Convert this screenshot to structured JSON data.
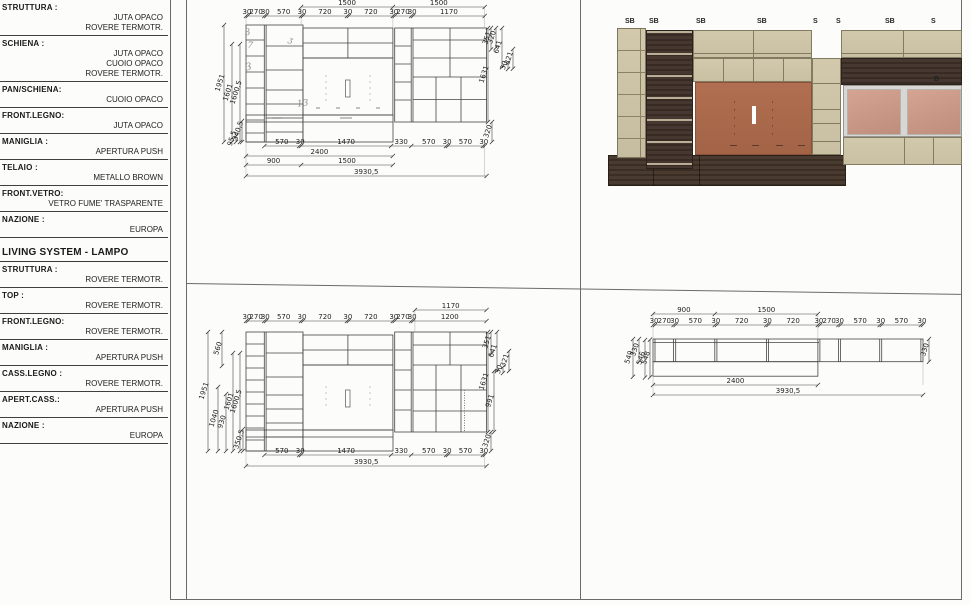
{
  "spec_block_top": {
    "rows": [
      {
        "label": "STRUTTURA  :",
        "values": [
          "JUTA OPACO",
          "ROVERE TERMOTR."
        ]
      },
      {
        "label": "SCHIENA    :",
        "values": [
          "JUTA OPACO",
          "CUOIO OPACO",
          "ROVERE TERMOTR."
        ]
      },
      {
        "label": "PAN/SCHIENA:",
        "values": [
          "CUOIO OPACO"
        ]
      },
      {
        "label": "FRONT.LEGNO:",
        "values": [
          "JUTA OPACO"
        ]
      },
      {
        "label": "MANIGLIA  :",
        "values": [
          "APERTURA PUSH"
        ]
      },
      {
        "label": "TELAIO    :",
        "values": [
          "METALLO BROWN"
        ]
      },
      {
        "label": "FRONT.VETRO:",
        "values": [
          "VETRO FUME'    TRASPARENTE"
        ]
      },
      {
        "label": "NAZIONE   :",
        "values": [
          "EUROPA"
        ]
      }
    ]
  },
  "spec_block_living": {
    "title": "LIVING SYSTEM - LAMPO",
    "rows": [
      {
        "label": "STRUTTURA :",
        "values": [
          "ROVERE TERMOTR."
        ]
      },
      {
        "label": "TOP       :",
        "values": [
          "ROVERE TERMOTR."
        ]
      },
      {
        "label": "FRONT.LEGNO:",
        "values": [
          "ROVERE TERMOTR."
        ]
      },
      {
        "label": "MANIGLIA  :",
        "values": [
          "APERTURA PUSH"
        ]
      },
      {
        "label": "CASS.LEGNO :",
        "values": [
          "ROVERE TERMOTR."
        ]
      },
      {
        "label": "APERT.CASS.:",
        "values": [
          "APERTURA PUSH"
        ]
      },
      {
        "label": "NAZIONE   :",
        "values": [
          "EUROPA"
        ]
      }
    ]
  },
  "drawings": {
    "front_a": {
      "top_row1": [
        "1500",
        "1500"
      ],
      "top_row2": [
        "30",
        "270",
        "30",
        "570",
        "30",
        "720",
        "30",
        "720",
        "30",
        "270",
        "30",
        "1170"
      ],
      "bottom_row1": [
        "570",
        "30",
        "1470",
        "330",
        "570",
        "30",
        "570",
        "30"
      ],
      "bottom_row2": [
        "2400"
      ],
      "bottom_row3": [
        "900",
        "1500"
      ],
      "bottom_row4": [
        "3930,5"
      ],
      "left_dims": [
        "1951",
        "1601",
        "1600,5",
        "95,5",
        "340,5"
      ],
      "right_dims": [
        "351",
        "320",
        "641",
        "30",
        "321",
        "1631",
        "320"
      ],
      "annotations": [
        "3",
        "7",
        "3",
        "13",
        "ʒ"
      ]
    },
    "front_b": {
      "top_row1": [
        "1170"
      ],
      "top_row2": [
        "30",
        "270",
        "30",
        "570",
        "30",
        "720",
        "30",
        "720",
        "30",
        "270",
        "30",
        "1200"
      ],
      "bottom_row1": [
        "570",
        "30",
        "1470",
        "330",
        "570",
        "30",
        "570",
        "30"
      ],
      "bottom_row2": [
        "3930,5"
      ],
      "left_dims": [
        "1951",
        "1040",
        "930",
        "1601",
        "1600,5",
        "560",
        "350,5"
      ],
      "right_dims": [
        "351",
        "641",
        "30",
        "321",
        "1631",
        "991",
        "320"
      ]
    },
    "plan_c": {
      "top_row1": [
        "900",
        "1500"
      ],
      "top_row2": [
        "30",
        "270",
        "30",
        "570",
        "30",
        "720",
        "30",
        "720",
        "30",
        "270",
        "30",
        "570",
        "30",
        "570",
        "30"
      ],
      "bottom_row1": [
        "2400"
      ],
      "bottom_row2": [
        "3930,5"
      ],
      "left_dims": [
        "549",
        "330",
        "546",
        "548"
      ],
      "right_dims": [
        "330"
      ]
    }
  },
  "render": {
    "top_labels": [
      "SB",
      "SB",
      "SB",
      "SB",
      "S",
      "S",
      "SB",
      "S"
    ],
    "side_label": "B",
    "colors": {
      "beige": "#cdc4a8",
      "dark_wood": "#46382f",
      "terracotta": "#a96a4c",
      "glass_pink": "#cb9787",
      "frame_gray": "#d8d7d3",
      "plinth": "#4a3b31"
    }
  }
}
